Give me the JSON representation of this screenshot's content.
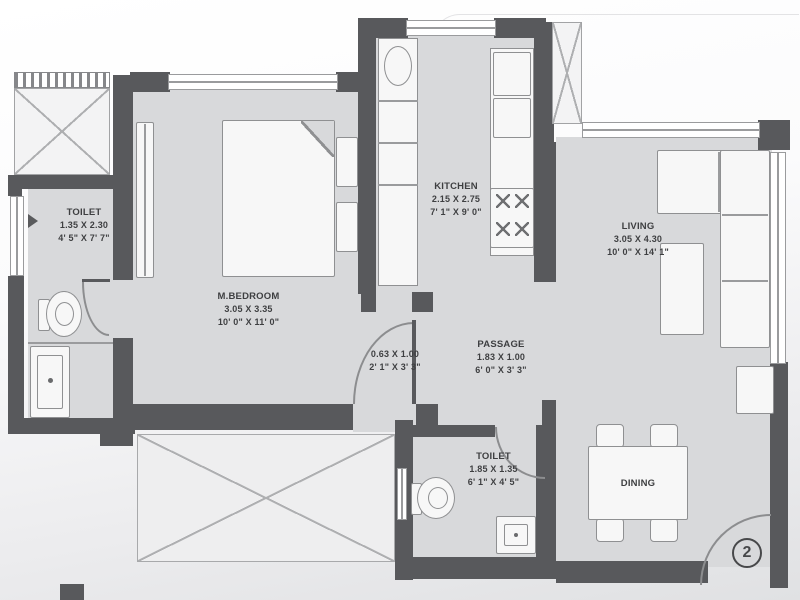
{
  "unit": {
    "number_label": "2"
  },
  "rooms": {
    "toilet_top": {
      "name": "TOILET",
      "dim_m": "1.35 X 2.30",
      "dim_ft": "4' 5\" X 7' 7\""
    },
    "master_bedroom": {
      "name": "M.BEDROOM",
      "dim_m": "3.05 X 3.35",
      "dim_ft": "10' 0\" X 11' 0\""
    },
    "kitchen": {
      "name": "KITCHEN",
      "dim_m": "2.15 X 2.75",
      "dim_ft": "7' 1\" X 9' 0\""
    },
    "living": {
      "name": "LIVING",
      "dim_m": "3.05 X 4.30",
      "dim_ft": "10' 0\" X 14' 1\""
    },
    "passage": {
      "name": "PASSAGE",
      "dim_m": "1.83 X 1.00",
      "dim_ft": "6' 0\" X 3' 3\""
    },
    "lobby": {
      "dim_m": "0.63 X 1.00",
      "dim_ft": "2' 1\" X 3' 3\""
    },
    "toilet_bottom": {
      "name": "TOILET",
      "dim_m": "1.85 X 1.35",
      "dim_ft": "6' 1\" X 4' 5\""
    },
    "dining": {
      "name": "DINING"
    }
  },
  "colors": {
    "wall": "#58595c",
    "floor": "#d8d9db",
    "fixture": "#f7f7f7",
    "accent_line": "#8f9092"
  }
}
